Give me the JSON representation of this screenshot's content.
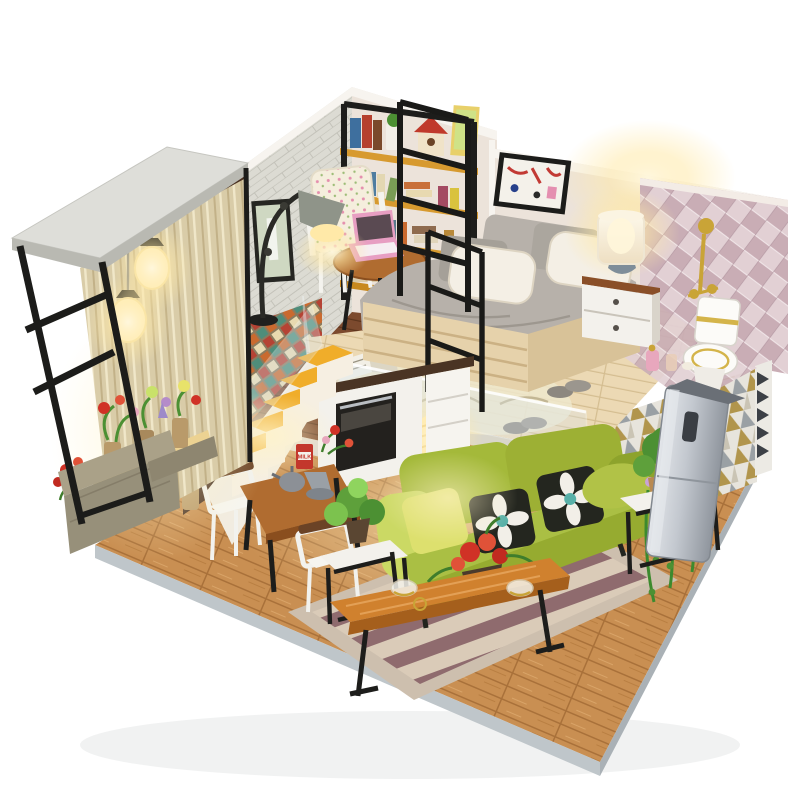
{
  "meta": {
    "description": "Product photo of a DIY miniature dollhouse loft apartment kit on a white background: upstairs bedroom with bed, nightstand and lamp, pink argyle bathroom corner with toilet, reading nook with bookshelf, armchair and floor lamp, glass balcony box with pendant lamps and flower pots, yellow loft stairs, and a lower living room with a green sofa, striped rug, wooden coffee bench, plants and a standing air conditioner.",
    "canvas": {
      "width": 800,
      "height": 800
    }
  },
  "labels": {
    "milk_can": "MILK"
  },
  "palette": {
    "background": "#ffffff",
    "floor_wood": "#c98f52",
    "floor_seam": "#a9713a",
    "platform_edge": "#bfc6ca",
    "deck_wood": "#ecd9b4",
    "deck_seam": "#d4bd90",
    "nook_floor": "#7c4a2e",
    "nook_seam": "#5c341c",
    "brick_wall": "#dcdbd3",
    "brick_line": "#c3c2b9",
    "cream_wall": "#ece3da",
    "wall_trim": "#f7f4ef",
    "walnut_panel": "#4a3122",
    "argyle_base": "#e2d0d4",
    "argyle_diamond": "#c9adb5",
    "triangle_gold": "#b1954c",
    "triangle_gray": "#9aa0a4",
    "triangle_bg": "#e7e4dc",
    "mosaic_orange": "#c96a2f",
    "mosaic_teal": "#4f8d7a",
    "mosaic_cream": "#e8d9b0",
    "mosaic_red": "#b54334",
    "stair_yellow": "#f0ad2a",
    "stair_stringer": "#f1ece1",
    "sofa_green": "#a4b93a",
    "sofa_green_light": "#cbd964",
    "sofa_green_dark": "#8da32c",
    "pillow_black": "#24261f",
    "pillow_white": "#f2efe8",
    "pillow_teal": "#58b0a8",
    "rug_stripe_a": "#8f6b6e",
    "rug_stripe_b": "#dacbb8",
    "rug_border": "#cdbfae",
    "bench_wood": "#d0812e",
    "bench_wood_dark": "#a55f1c",
    "table_wood": "#b06c30",
    "frame_black": "#1d1d1b",
    "lamp_glow": "#ffe9a8",
    "ac_silver_light": "#d7dadf",
    "ac_silver_dark": "#9ba1a9",
    "white_furniture": "#f3f1ec",
    "gold": "#c9a437",
    "plant_green": "#4c9033",
    "plant_green_dark": "#33691f",
    "flower_red": "#d03226",
    "flower_pink": "#e8a7bd",
    "curtain": "#d9cca8",
    "stone_planter": "#97907a",
    "blanket_gray": "#b7b1aa",
    "satin_white": "#f4efe5",
    "laptop_pink": "#e79ec2",
    "milk_can_red": "#c3372c"
  },
  "objects": {
    "balcony": "glass balcony box with black metal frame, white top slab, sheer curtain, two glowing pendant lamps, potted flowers and stone planter",
    "reading_nook": "white brick wall, framed print, black arc floor lamp, floral armchair, round side table with pink laptop, wooden bookshelf with books, plant pot and red birdhouse",
    "bedroom": "cream wall with abstract framed art, gray knit bed with white satin pillows, white nightstand with wood top, glowing table lamp",
    "bathroom": "pink argyle tiled corner with gold shower fixture, white toilet with gold trim, perfume bottles",
    "loft_deck": "pale wood loft floor with clear acrylic guard rail, leaf-print rug, slippers, open magazine and hanging ball pendant light",
    "stairs": "yellow-tread loft staircase with white stringer and clear guard panel over a kitchen unit with black oven",
    "dining": "wooden dining table with metal kettles, red MILK canister and flowers, two white-and-wood chairs, vase of orange roses",
    "living_room": "green fabric sofa with black flower pillows, striped rug, wooden coffee bench with red flowers and glass cups, white side tables with potted plants, trailing vine plant, standing air conditioner, triangle-pattern wallpaper",
    "base": "warm wood plank platform floor with light gray edge"
  }
}
